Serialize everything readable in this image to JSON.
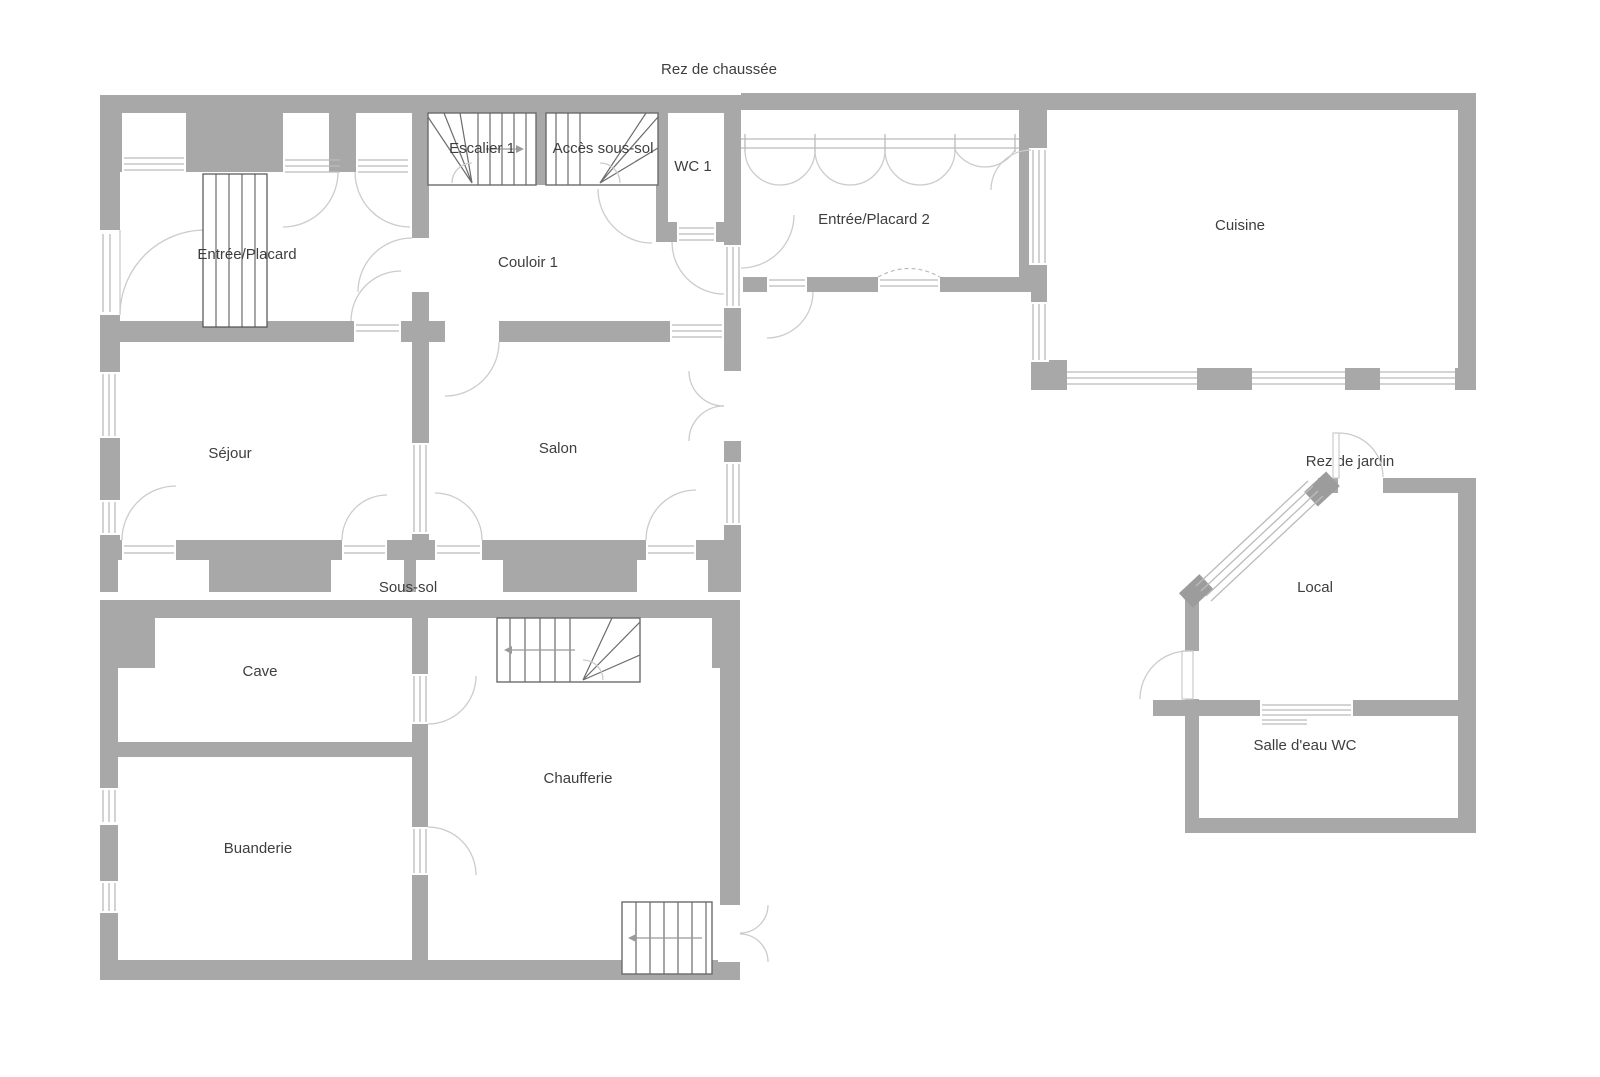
{
  "document": {
    "type": "floor-plan"
  },
  "titles": {
    "ground_floor": "Rez de chaussée",
    "basement": "Sous-sol",
    "garden_level": "Rez de jardin"
  },
  "rooms": {
    "entree_placard": "Entrée/Placard",
    "escalier_1": "Escalier 1",
    "acces_sous_sol": "Accès sous-sol",
    "wc_1": "WC 1",
    "couloir_1": "Couloir 1",
    "entree_placard_2": "Entrée/Placard 2",
    "cuisine": "Cuisine",
    "sejour": "Séjour",
    "salon": "Salon",
    "cave": "Cave",
    "chaufferie": "Chaufferie",
    "buanderie": "Buanderie",
    "local": "Local",
    "salle_eau_wc": "Salle d'eau WC"
  },
  "colors": {
    "wall": "#a8a8a8",
    "wall_dark": "#9c9c9c",
    "line_light": "#bbbbbb",
    "line_mid": "#9a9a9a",
    "line_door": "#cccccc",
    "stair_line": "#6b6b6b",
    "closet_line": "#4f4f4f",
    "text": "#3e3e3e",
    "background": "#ffffff"
  }
}
